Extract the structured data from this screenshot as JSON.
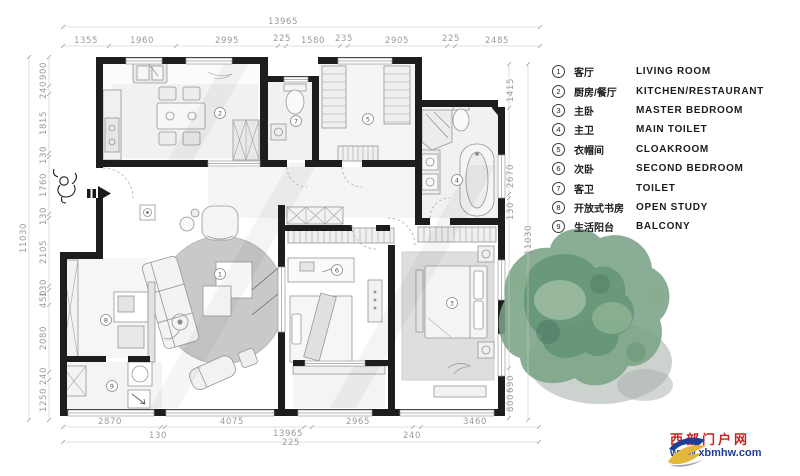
{
  "legend": {
    "items": [
      {
        "num": "1",
        "zh": "客厅",
        "en": "LIVING ROOM"
      },
      {
        "num": "2",
        "zh": "厨房/餐厅",
        "en": "KITCHEN/RESTAURANT"
      },
      {
        "num": "3",
        "zh": "主卧",
        "en": "MASTER BEDROOM"
      },
      {
        "num": "4",
        "zh": "主卫",
        "en": "MAIN TOILET"
      },
      {
        "num": "5",
        "zh": "衣帽间",
        "en": "CLOAKROOM"
      },
      {
        "num": "6",
        "zh": "次卧",
        "en": "SECOND BEDROOM"
      },
      {
        "num": "7",
        "zh": "客卫",
        "en": "TOILET"
      },
      {
        "num": "8",
        "zh": "开放式书房",
        "en": "OPEN STUDY"
      },
      {
        "num": "9",
        "zh": "生活阳台",
        "en": "BALCONY"
      }
    ]
  },
  "dims": {
    "top": {
      "overall": "13965",
      "segments": [
        "1355",
        "1960",
        "2995",
        "225",
        "1580",
        "235",
        "2905",
        "225",
        "2485"
      ]
    },
    "bottom": {
      "overall": "13965",
      "row1": [
        "2870",
        "4075",
        "2965",
        "3460"
      ],
      "row2": [
        "130",
        "225",
        "240"
      ]
    },
    "left": {
      "overall": "11030",
      "segments": [
        "900",
        "240",
        "1815",
        "130",
        "1760",
        "130",
        "2105",
        "130",
        "450",
        "2080",
        "240",
        "1250"
      ]
    },
    "right": {
      "overall": "11030",
      "segments": [
        "1415",
        "2670",
        "130",
        "690",
        "800"
      ]
    }
  },
  "watermark": {
    "site_name": "西部门户网",
    "site_url": "www.xbmhw.com",
    "accent_red": "#c5231f",
    "accent_blue": "#1e3f97",
    "accent_yellow": "#e3b63c"
  },
  "colors": {
    "wall": "#1d1d1d",
    "dim_text": "#9a9a9a",
    "rug_gray": "#c9c9c9",
    "tree_green": "#7aa386"
  }
}
